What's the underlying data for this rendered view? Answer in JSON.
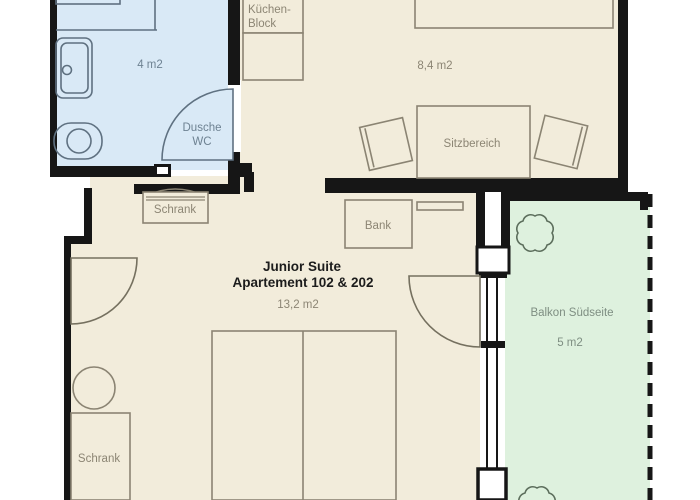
{
  "floor_plan": {
    "suite": {
      "title": "Junior Suite",
      "subtitle": "Apartement 102 & 202",
      "area": "13,2 m2"
    },
    "bathroom": {
      "area": "4 m2",
      "label_line1": "Dusche",
      "label_line2": "WC"
    },
    "kitchen": {
      "label_line1": "Küchen-",
      "label_line2": "Block"
    },
    "living_room": {
      "area": "8,4 m2",
      "seating_label": "Sitzbereich"
    },
    "hallway": {
      "wardrobe_label": "Schrank"
    },
    "bench_label": "Bank",
    "bedroom_wardrobe_label": "Schrank",
    "balcony": {
      "label": "Balkon Südseite",
      "area": "5 m2"
    },
    "colors": {
      "room_beige": "#f2ecdb",
      "bathroom_blue": "#d9e9f6",
      "balcony_green": "#def1de",
      "wall_black": "#161616",
      "furniture_line": "#8b8473",
      "label_gray": "#8c8574",
      "label_blue": "#6e8292",
      "label_green": "#7e8e82",
      "title_dark": "#1c1c1c"
    }
  }
}
